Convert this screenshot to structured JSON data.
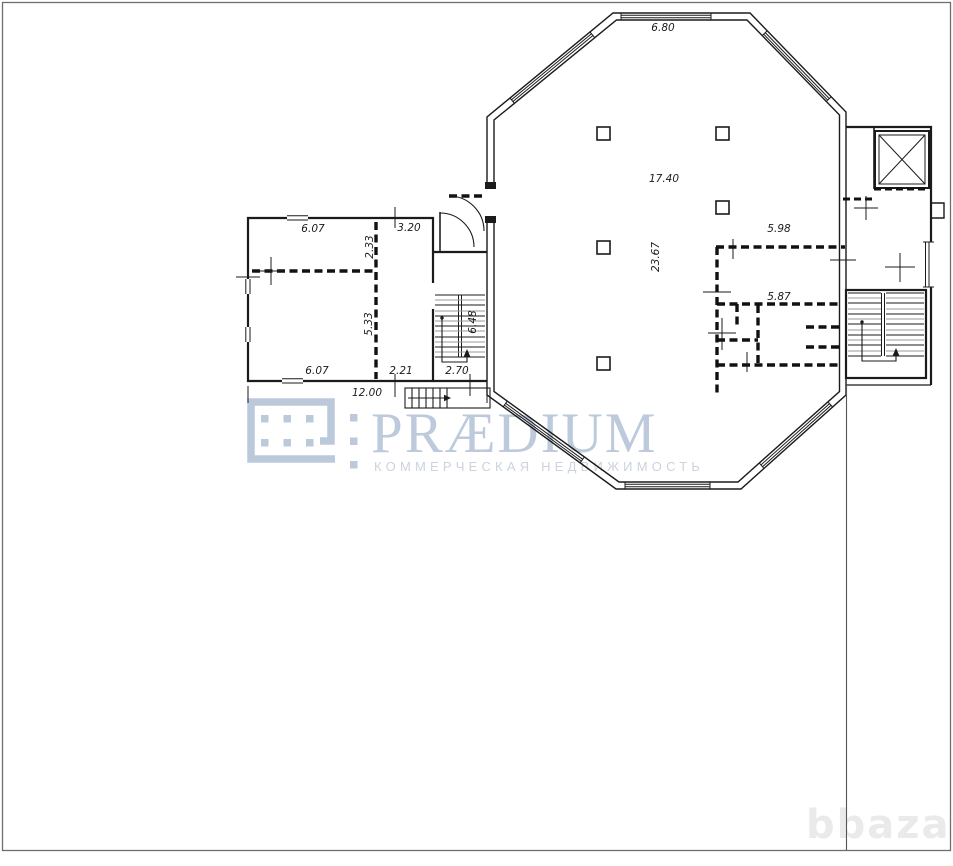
{
  "page": {
    "background": "#ffffff",
    "border_color": "#6e6e6e"
  },
  "watermark": {
    "brand": "PRÆDIUM",
    "tagline": "КОММЕРЧЕСКАЯ НЕДВИЖИМОСТЬ",
    "logo_color": "#bcc9db",
    "brand_color": "#bdcadc",
    "tagline_color": "#ccd3dd"
  },
  "portal_watermark": {
    "text": "bbaza",
    "color": "#eaeaea"
  },
  "plan": {
    "line_color": "#1b1b1b",
    "stair_tread_gray": "#9a9a9a",
    "labels": {
      "hall_top_width": "6.80",
      "hall_width": "17.40",
      "hall_length": "23.67",
      "right_room_width": "5.98",
      "right_inner_room_width": "5.87",
      "annex_top_room_width": "6.07",
      "annex_top_room_depth": "2.33",
      "annex_top_corridor_width": "3.20",
      "annex_bottom_room_depth": "5.33",
      "annex_bottom_room_width": "6.07",
      "annex_bottom_corridor_width": "2.21",
      "stair_bay_width": "2.70",
      "stair_bay_depth": "6.48",
      "annex_total_width": "12.00"
    }
  }
}
